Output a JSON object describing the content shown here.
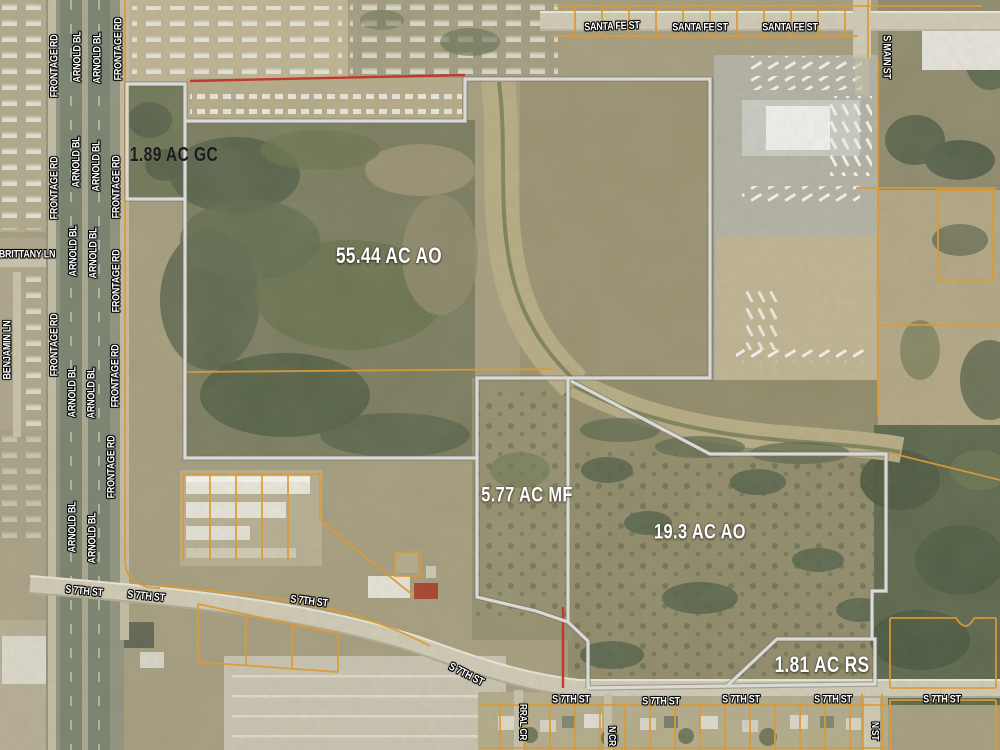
{
  "street_names": {
    "santa_fe": "SANTA FE ST",
    "s_main": "S MAIN ST",
    "s_seventh": "S 7TH ST",
    "frontage": "FRONTAGE RD",
    "arnold": "ARNOLD BL",
    "brittany": "BRITTANY LN",
    "benjamin": "BENJAMIN LN",
    "corral": "RRAL CR",
    "n_cr": "N CR",
    "n_st": "N ST"
  },
  "parcels": [
    {
      "label": "1.89 AC GC",
      "acres": "1.89",
      "zoning": "GC"
    },
    {
      "label": "55.44 AC AO",
      "acres": "55.44",
      "zoning": "AO"
    },
    {
      "label": "5.77 AC MF",
      "acres": "5.77",
      "zoning": "MF"
    },
    {
      "label": "19.3 AC AO",
      "acres": "19.3",
      "zoning": "AO"
    },
    {
      "label": "1.81 AC RS",
      "acres": "1.81",
      "zoning": "RS"
    }
  ],
  "colors": {
    "parcel_boundary": "#d9d9d6",
    "cadastral_line": "#dc9a35",
    "highlight_line": "#c0392b",
    "street_label": "#ffffff",
    "acreage_label_light": "#ffffff",
    "acreage_label_dark": "#1b1b1b"
  }
}
